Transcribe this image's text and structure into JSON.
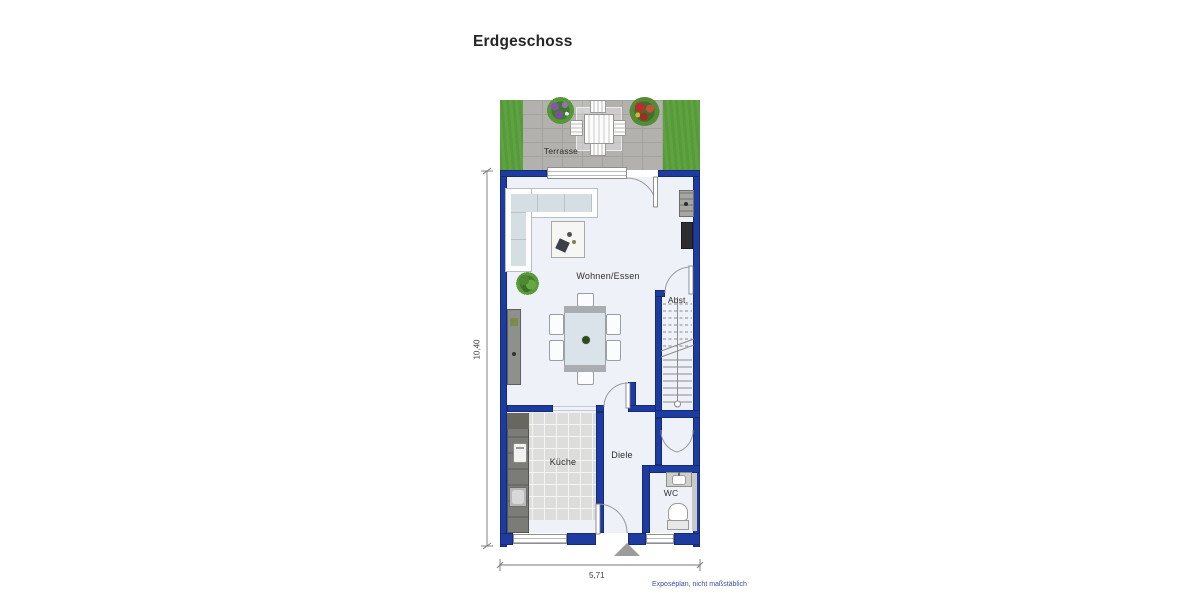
{
  "title": "Erdgeschoss",
  "plan": {
    "rooms": {
      "terrasse": {
        "label": "Terrasse"
      },
      "wohnen_essen": {
        "label": "Wohnen/Essen"
      },
      "abstellraum": {
        "label": "Abst."
      },
      "kueche": {
        "label": "Küche"
      },
      "diele": {
        "label": "Diele"
      },
      "wc": {
        "label": "WC"
      }
    },
    "dimensions": {
      "height_label": "10,40",
      "width_label": "5,71"
    },
    "footer_note": "Exposéplan, nicht maßstäblich",
    "colors": {
      "wall": "#1e3c9f",
      "wall_edge": "#142c78",
      "floor": "#eef2f8",
      "grass": "#5da33f",
      "pavement": "#b2b1ae",
      "tile": "#dddddb",
      "counter": "#7b7b77",
      "note": "#3c4f9f",
      "label": "#2e2e2e"
    }
  }
}
